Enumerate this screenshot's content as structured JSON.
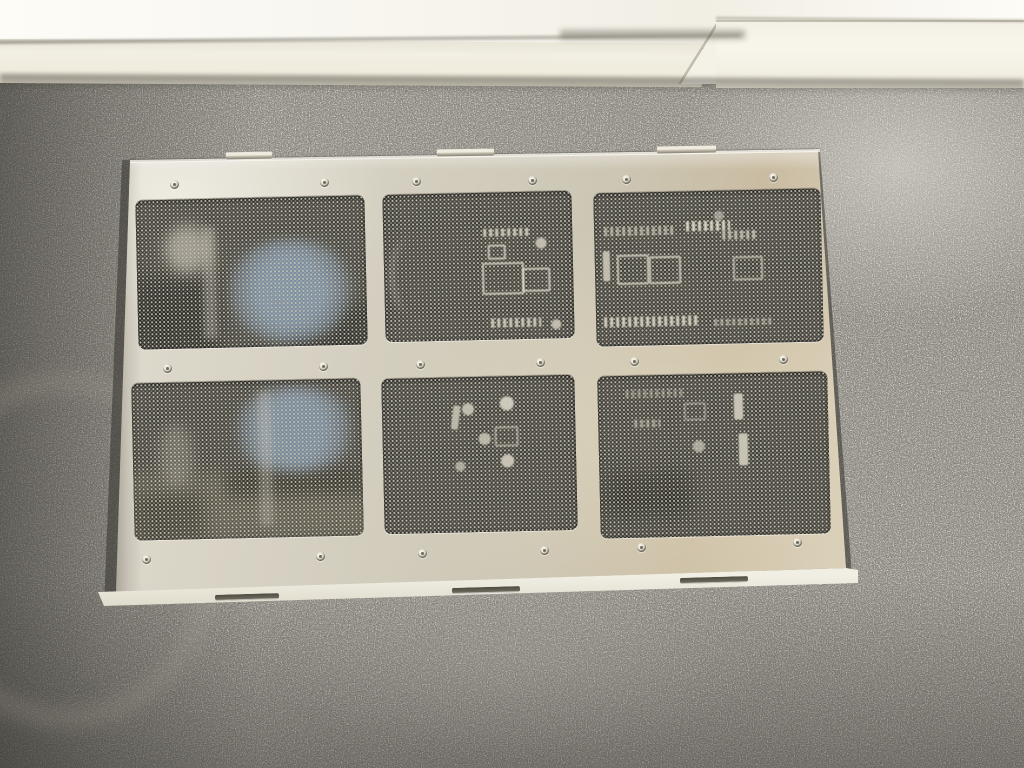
{
  "image": {
    "type": "photograph",
    "subject": "Brushed aluminum equipment cover panel with six perforated honeycomb mesh vent windows (2 rows x 3 columns)",
    "setting": "Panel lying flat on gray shag carpet against a white wall baseboard, sunlight from upper right",
    "visible_text": "none",
    "visible_through_mesh": {
      "top_left_vent": "blue fan hub and bright reflection",
      "top_middle_vent": "white PCB connectors and sockets",
      "top_right_vent": "circuit board with connector rows and pin headers",
      "bottom_left_vent": "blue fan hub over tan circuit board",
      "bottom_middle_vent": "round capacitor tops",
      "bottom_right_vent": "faint connectors and standoffs"
    }
  },
  "panel": {
    "vent_rows": 2,
    "vent_cols": 3,
    "vent_count": 6,
    "screw_count": 18,
    "top_tab_count": 3,
    "bottom_slot_count": 3
  },
  "colors": {
    "wall": "#f7f5ee",
    "wall-bright": "#fdfcf7",
    "baseboard": "#efebdd",
    "baseboard-bright": "#f8f5ec",
    "carpet": "#8f8c84",
    "carpet-dark": "#4e4b45",
    "carpet-light": "#cfccc3",
    "panel-light": "#e0dcd0",
    "panel-mid": "#ccc6b4",
    "panel-warm": "#c9bca2",
    "panel-lip": "#f1efe4",
    "mesh-dark": "#3d3c37",
    "mesh-dot": "#c7c2b2",
    "fan-blue": "#7e95ad",
    "component": "#eae5d5",
    "shadow": "#34322d"
  }
}
